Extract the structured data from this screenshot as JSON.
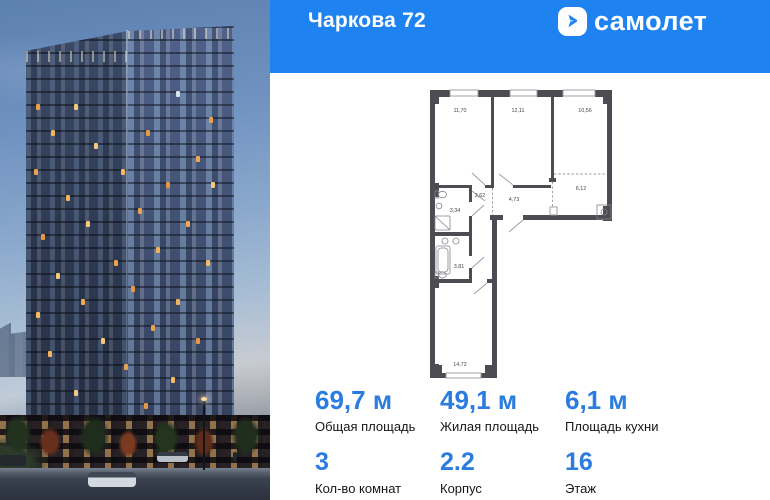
{
  "header": {
    "title": "Чаркова 72",
    "brand": "самолет"
  },
  "icons": {
    "logo_icon": "arrow-right-squircle"
  },
  "colors": {
    "brand_blue": "#1e82f0",
    "value_blue": "#2b7ce0",
    "plan_wall": "#4c4c52"
  },
  "floor_plan": {
    "areas": {
      "room1": "11,70",
      "room2": "12,11",
      "room3": "10,56",
      "kitchen": "6,12",
      "closet": "2,62",
      "hallway": "4,73",
      "bathroom_small": "3,34",
      "bathroom_large": "3,81",
      "room_bottom": "14,72"
    }
  },
  "stats": {
    "items": [
      {
        "value": "69,7 м",
        "label": "Общая площадь"
      },
      {
        "value": "49,1 м",
        "label": "Жилая площадь"
      },
      {
        "value": "6,1 м",
        "label": "Площадь кухни"
      },
      {
        "value": "3",
        "label": "Кол-во комнат"
      },
      {
        "value": "2.2",
        "label": "Корпус"
      },
      {
        "value": "16",
        "label": "Этаж"
      }
    ]
  }
}
